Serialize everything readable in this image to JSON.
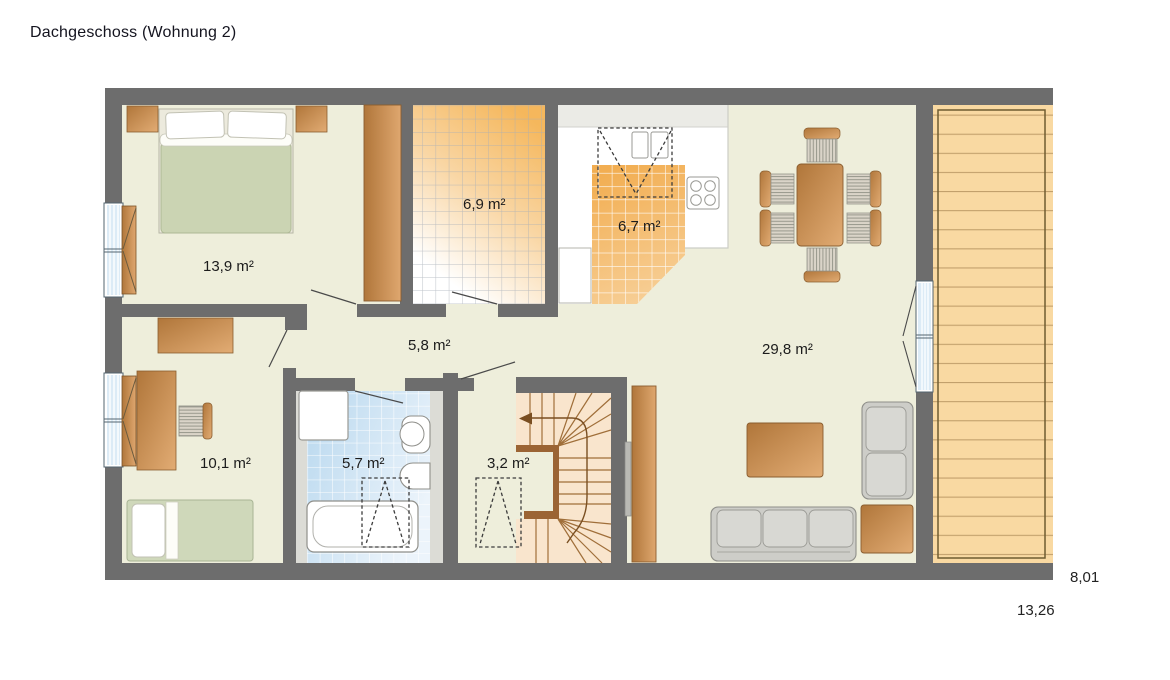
{
  "title": "Dachgeschoss (Wohnung 2)",
  "floor_plan": {
    "rooms": [
      {
        "name": "bedroom",
        "area": "13,9 m²"
      },
      {
        "name": "tiled-room",
        "area": "6,9 m²"
      },
      {
        "name": "kitchen",
        "area": "6,7 m²"
      },
      {
        "name": "living-dining",
        "area": "29,8 m²"
      },
      {
        "name": "hallway",
        "area": "5,8 m²"
      },
      {
        "name": "office",
        "area": "10,1 m²"
      },
      {
        "name": "bathroom",
        "area": "5,7 m²"
      },
      {
        "name": "storage",
        "area": "3,2 m²"
      }
    ],
    "dimensions": {
      "side": "8,01",
      "bottom": "13,26"
    },
    "colors": {
      "wall": "#6d6d6d",
      "floor": "#eeeedb",
      "wood": "#c98f52",
      "balcony_plank": "#f9d9a2",
      "tile_orange": "#f3b35e",
      "tile_blue": "#bcd9ee",
      "upholstery": "#cdcdc8",
      "bed_green": "#cbd4b3"
    }
  }
}
